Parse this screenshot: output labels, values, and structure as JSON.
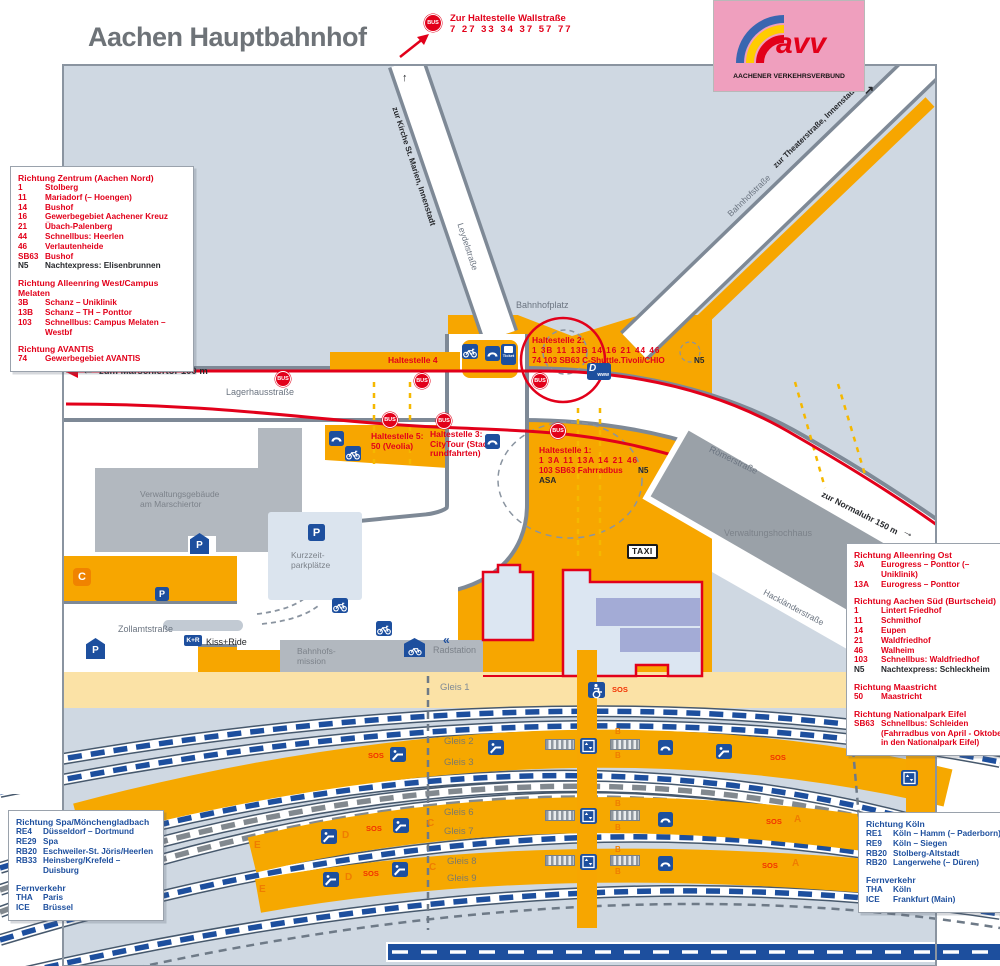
{
  "title": "Aachen Hauptbahnhof",
  "logo": {
    "mark": "avv",
    "caption": "AACHENER VERKEHRSVERBUND"
  },
  "top_note": {
    "bus": "BUS",
    "line1": "Zur Haltestelle Wallstraße",
    "line2": "7 27 33 34 37 57 77"
  },
  "map": {
    "st_marien": "zur Kirche St. Marien, Innenstadt",
    "leydel": "Leydelstraße",
    "bahnhofplatz": "Bahnhofplatz",
    "bahnhofstrasse": "Bahnhofstraße",
    "theaterstrasse": "zur Theaterstraße, Innenstadt",
    "lagerhausstrasse": "Lagerhausstraße",
    "marschiertor": "zum Marschiertor 100 m",
    "roemerstrasse": "Römerstraße",
    "normaluhr": "zur Normaluhr 150 m",
    "hacklaenderstrasse": "Hackländerstraße",
    "zollamtstrasse": "Zollamtstraße",
    "verwaltungsgebaeude": "Verwaltungsgebäude\nam Marschiertor",
    "kurzzeitparkplaetze": "Kurzzeit-\nparkplätze",
    "bahnhofsmission": "Bahnhofs-\nmission",
    "radstation": "Radstation",
    "verwaltungshochhaus": "Verwaltungshochhaus",
    "kissride": "Kiss+Ride",
    "h4": "Haltestelle 4",
    "h2_title": "Haltestelle 2:",
    "h2_l1": "1 3B 11 13B 14 16 21 44 46",
    "h2_l2": "74 103 SB63 C-Shuttle.Tivoli/CHIO",
    "h2_n5": "N5",
    "h5": "Haltestelle 5:\n50 (Veolia)",
    "h3": "Haltestelle 3:\nCityTour (Stadt-\nrundfahrten)",
    "h1_title": "Haltestelle 1:",
    "h1_l1": "1 3A 11 13A 14 21 46",
    "h1_l2": "103 SB63 Fahrradbus",
    "h1_n5": "N5",
    "h1_asa": "ASA",
    "g1": "Gleis 1",
    "g2": "Gleis 2",
    "g3": "Gleis 3",
    "g6": "Gleis 6",
    "g7": "Gleis 7",
    "g8": "Gleis 8",
    "g9": "Gleis 9",
    "sos": "SOS",
    "bus": "BUS",
    "taxi": "TAXI",
    "kr": "K+R",
    "ticket": "Ticket",
    "d": "D",
    "www": "www",
    "p": "P",
    "c": "C",
    "sec_a": "A",
    "sec_b": "B",
    "sec_c": "C",
    "sec_d": "D",
    "sec_e": "E",
    "arrow_up": "↑",
    "arrow_upright": "↗",
    "arrow_left": "←",
    "arrow_right": "→",
    "chevrons": "«"
  },
  "colors": {
    "accent_red": "#e2001a",
    "accent_blue": "#1d4f9e",
    "zone_orange": "#f7a600",
    "map_bg": "#cfd8e2"
  },
  "panels": {
    "nw": [
      {
        "h": "Richtung Zentrum (Aachen Nord)"
      },
      {
        "n": "1",
        "d": "Stolberg"
      },
      {
        "n": "11",
        "d": "Mariadorf (– Hoengen)"
      },
      {
        "n": "14",
        "d": "Bushof"
      },
      {
        "n": "16",
        "d": "Gewerbegebiet Aachener Kreuz"
      },
      {
        "n": "21",
        "d": "Übach-Palenberg"
      },
      {
        "n": "44",
        "d": "Schnellbus: Heerlen"
      },
      {
        "n": "46",
        "d": "Verlautenheide"
      },
      {
        "n": "SB63",
        "d": "Bushof"
      },
      {
        "n": "N5",
        "d": "Nachtexpress: Elisenbrunnen",
        "k": "black"
      },
      {
        "sp": 1
      },
      {
        "h": "Richtung Alleenring West/Campus Melaten"
      },
      {
        "n": "3B",
        "d": "Schanz – Uniklinik"
      },
      {
        "n": "13B",
        "d": "Schanz – TH – Ponttor"
      },
      {
        "n": "103",
        "d": "Schnellbus: Campus Melaten – Westbf"
      },
      {
        "sp": 1
      },
      {
        "h": "Richtung AVANTIS"
      },
      {
        "n": "74",
        "d": "Gewerbegebiet AVANTIS"
      }
    ],
    "e": [
      {
        "h": "Richtung Alleenring Ost"
      },
      {
        "n": "3A",
        "d": "Eurogress – Ponttor (– Uniklinik)"
      },
      {
        "n": "13A",
        "d": "Eurogress – Ponttor"
      },
      {
        "sp": 1
      },
      {
        "h": "Richtung Aachen Süd (Burtscheid)"
      },
      {
        "n": "1",
        "d": "Lintert Friedhof"
      },
      {
        "n": "11",
        "d": "Schmithof"
      },
      {
        "n": "14",
        "d": "Eupen"
      },
      {
        "n": "21",
        "d": "Waldfriedhof"
      },
      {
        "n": "46",
        "d": "Walheim"
      },
      {
        "n": "103",
        "d": "Schnellbus: Waldfriedhof"
      },
      {
        "n": "N5",
        "d": "Nachtexpress: Schleckheim",
        "k": "black"
      },
      {
        "sp": 1
      },
      {
        "h": "Richtung Maastricht"
      },
      {
        "n": "50",
        "d": "Maastricht"
      },
      {
        "sp": 1
      },
      {
        "h": "Richtung Nationalpark Eifel"
      },
      {
        "n": "SB63",
        "d": "Schnellbus: Schleiden\n(Fahrradbus von April - Oktober\nin den Nationalpark Eifel)"
      }
    ],
    "sw": [
      {
        "h": "Richtung Spa/Mönchengladbach"
      },
      {
        "n": "RE4",
        "d": "Düsseldorf – Dortmund"
      },
      {
        "n": "RE29",
        "d": "Spa"
      },
      {
        "n": "RB20",
        "d": "Eschweiler-St. Jöris/Heerlen"
      },
      {
        "n": "RB33",
        "d": "Heinsberg/Krefeld – Duisburg"
      },
      {
        "sp": 1
      },
      {
        "h": "Fernverkehr"
      },
      {
        "n": "THA",
        "d": "Paris"
      },
      {
        "n": "ICE",
        "d": "Brüssel"
      }
    ],
    "se": [
      {
        "h": "Richtung Köln"
      },
      {
        "n": "RE1",
        "d": "Köln – Hamm (– Paderborn)"
      },
      {
        "n": "RE9",
        "d": "Köln – Siegen"
      },
      {
        "n": "RB20",
        "d": "Stolberg-Altstadt"
      },
      {
        "n": "RB20",
        "d": "Langerwehe (– Düren)"
      },
      {
        "sp": 1
      },
      {
        "h": "Fernverkehr"
      },
      {
        "n": "THA",
        "d": "Köln"
      },
      {
        "n": "ICE",
        "d": "Frankfurt (Main)"
      }
    ]
  }
}
